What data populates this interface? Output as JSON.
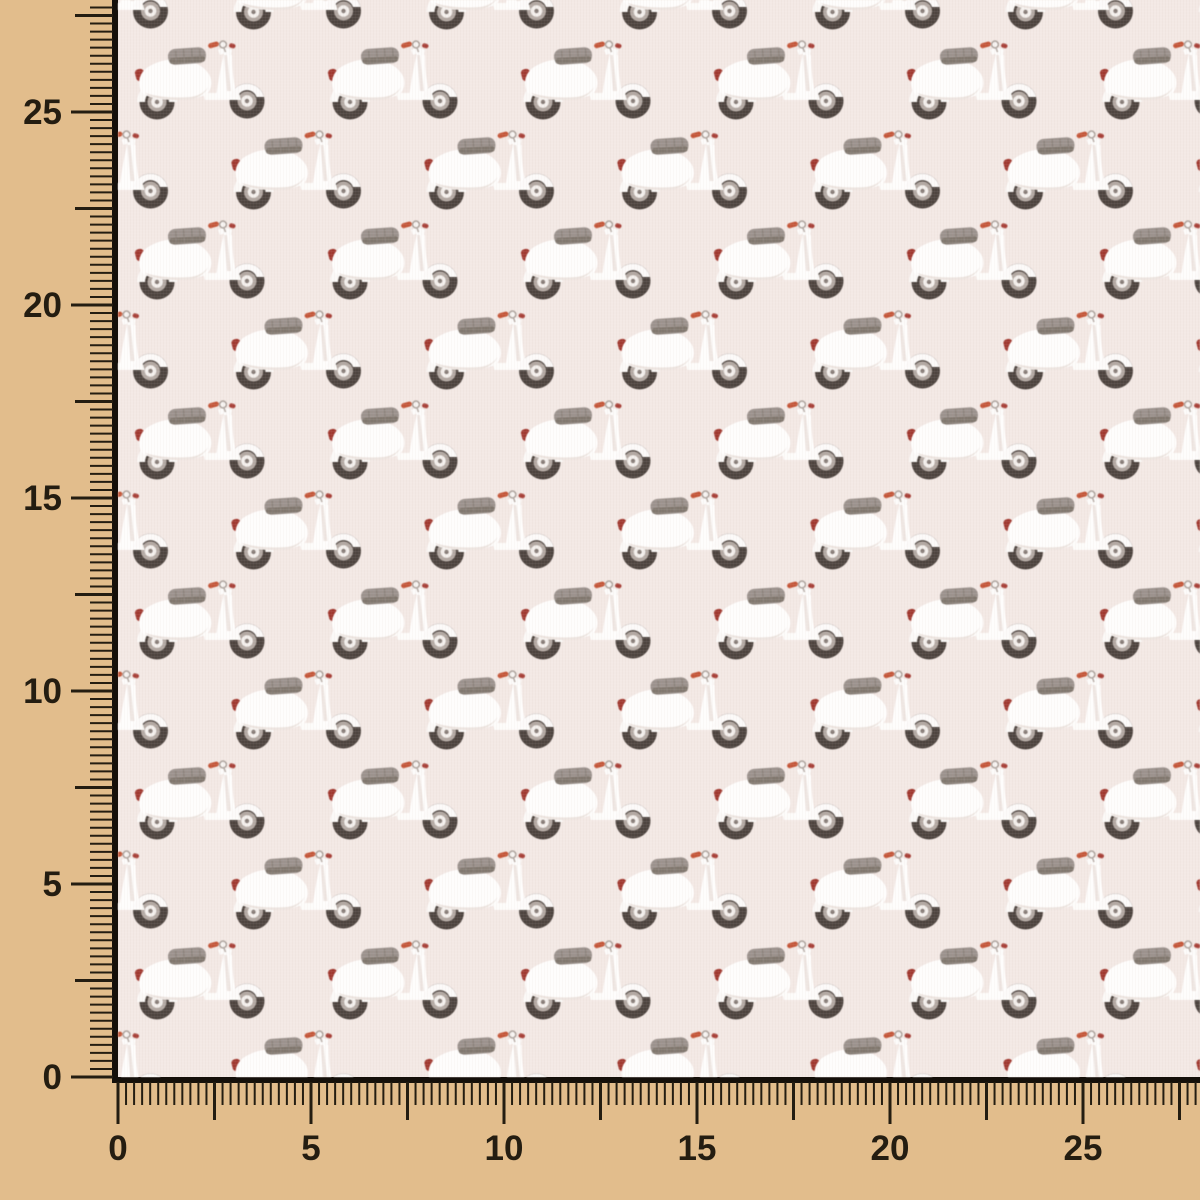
{
  "scene": {
    "description": "Pale pink cotton fabric swatch printed with a repeating white vintage scooter (vespa) motif, photographed over a tan board with centimeter rulers along the left and bottom edges"
  },
  "colors": {
    "ruler_background": "#e2bd8c",
    "tick": "#241d11",
    "label": "#241d11",
    "fabric_background": "#f3e9e5",
    "fabric_edge_line": "#15100a",
    "scooter_body": "#fefdfc",
    "scooter_body_shadow": "#e9dfda",
    "scooter_seat": "#9c938e",
    "scooter_seat_shadow": "#81786f",
    "scooter_tire": "#4e4540",
    "scooter_wheel_ring": "#b3a9a3",
    "scooter_hub": "#f4f0ed",
    "scooter_tail_light_red": "#a13a31",
    "scooter_grip_orange": "#c4573a",
    "scooter_mirror_ring": "#a89e98"
  },
  "rulers": {
    "vertical": {
      "labels": [
        "25",
        "20",
        "15",
        "10",
        "5",
        "0"
      ]
    },
    "horizontal": {
      "labels": [
        "0",
        "5",
        "10",
        "15",
        "20",
        "25"
      ]
    }
  }
}
